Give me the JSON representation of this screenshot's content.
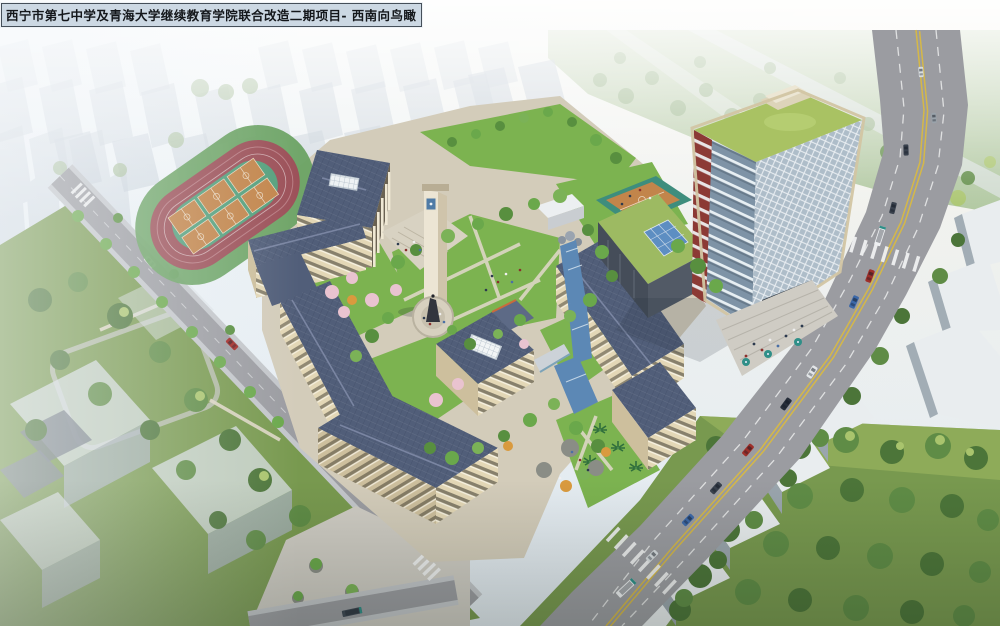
{
  "title_bar": {
    "text": "西宁市第七中学及青海大学继续教育学院联合改造二期项目- 西南向鸟瞰"
  },
  "colors": {
    "sky_top": "#f0f5f8",
    "sky_bottom": "#e1e9ef",
    "haze_city": "#c2ccd6",
    "track": "#9c5159",
    "track_infield": "#55a07d",
    "court_orange": "#c2854b",
    "court_line": "#ead9c2",
    "roof_slate": "#515e79",
    "wall_beige": "#e3d7b6",
    "lawn": "#7cb350",
    "blossom": "#e9c3d0",
    "water": "#5c88b5",
    "road": "#9b9ca1",
    "sidewalk": "#c3c6ca",
    "lane_yellow": "#d9ba43",
    "park_green": "#78994f",
    "tower_roof": "#a9c263",
    "tower_frame": "#d2c5a3",
    "tower_accent": "#8c3a35",
    "tower_glass": "#7e93a6",
    "tower_glass_light": "#aebdc9",
    "podium_skylight": "#5d8ec2",
    "white_building": "#e9edef",
    "plaza": "#cfccc4",
    "title_bg": "#ccd8e3",
    "title_border": "#454f59"
  }
}
